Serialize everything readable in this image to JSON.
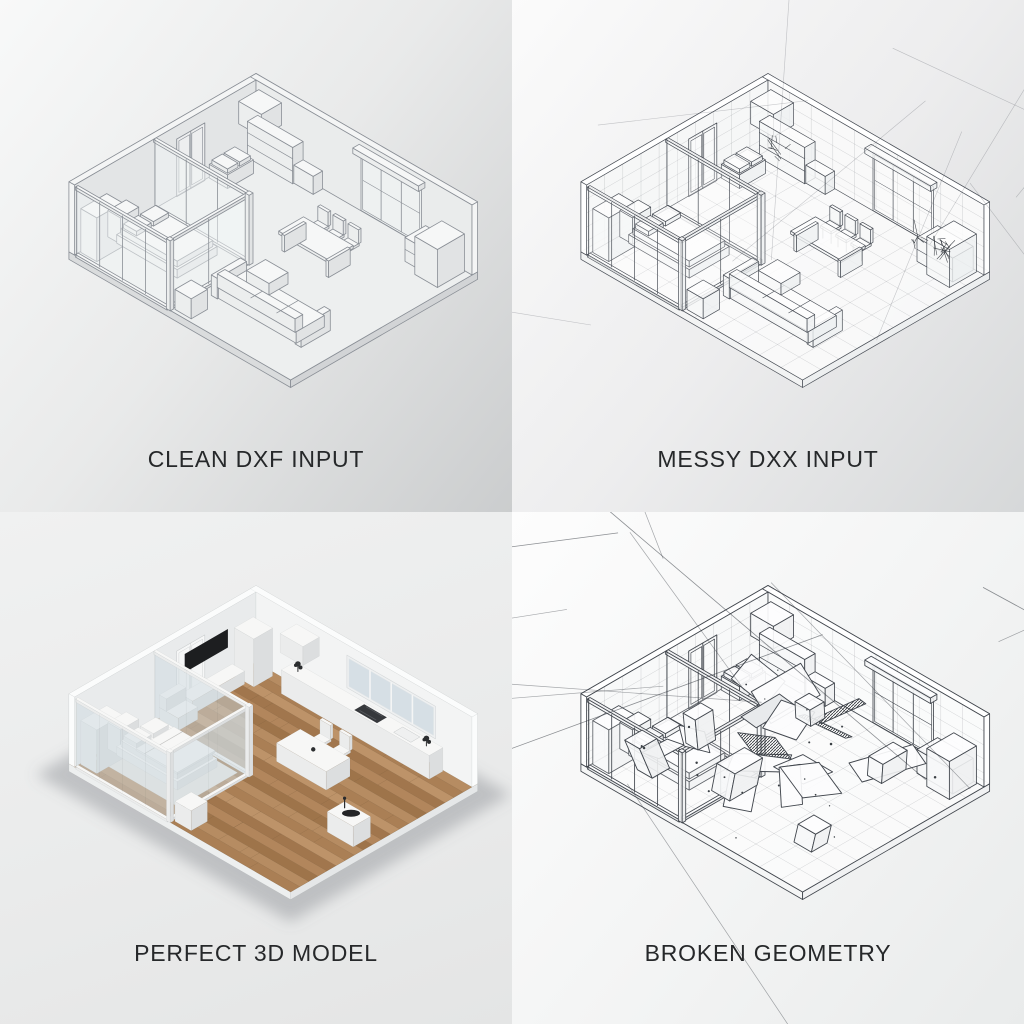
{
  "page": {
    "title": "DXF to 3D model comparison grid"
  },
  "panels": [
    {
      "id": "clean-dxf-input",
      "caption": "CLEAN DXF INPUT",
      "style": "clean"
    },
    {
      "id": "messy-dxx-input",
      "caption": "MESSY DXX INPUT",
      "style": "messy"
    },
    {
      "id": "perfect-3d-model",
      "caption": "PERFECT 3D MODEL",
      "style": "perfect"
    },
    {
      "id": "broken-geometry",
      "caption": "BROKEN GEOMETRY",
      "style": "broken"
    }
  ],
  "colors": {
    "caption_text": "#26282a",
    "line_soft": "#8a8f96",
    "line_ink": "#42474e",
    "wood_floor": "#ab8159",
    "tv_black": "#1d1e20",
    "wall_white": "#f1f2f2"
  }
}
